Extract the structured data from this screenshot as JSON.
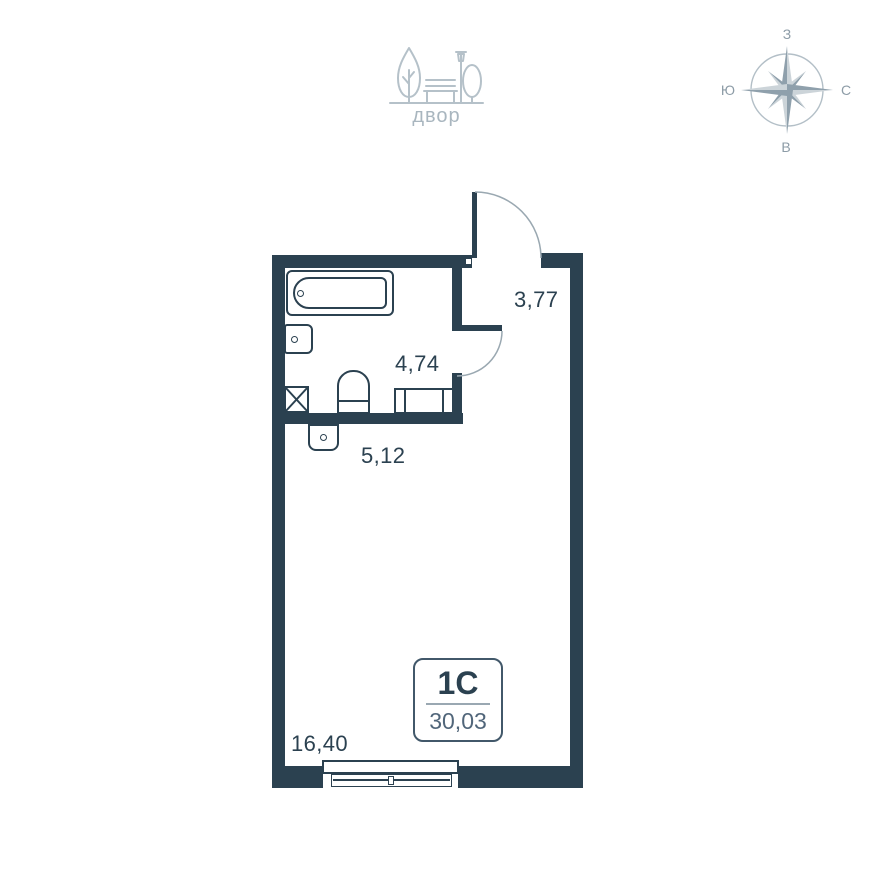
{
  "courtyard": {
    "label": "двор"
  },
  "compass": {
    "top": "З",
    "left": "Ю",
    "right": "С",
    "bottom": "В"
  },
  "plan": {
    "rooms": [
      {
        "name": "hallway",
        "area": "3,77"
      },
      {
        "name": "bathroom",
        "area": "4,74"
      },
      {
        "name": "kitchen-niche",
        "area": "5,12"
      },
      {
        "name": "living-room",
        "area": "16,40"
      }
    ],
    "stamp": {
      "type": "1С",
      "total_area": "30,03"
    }
  },
  "colors": {
    "wall": "#2b4150",
    "label_text": "#2b4150",
    "stamp_secondary_text": "#51667a",
    "icon_gray": "#b5c1c9",
    "compass_dark": "#8fa0ac",
    "compass_light": "#ccd4d9",
    "door_arc": "#9aa8b1"
  }
}
